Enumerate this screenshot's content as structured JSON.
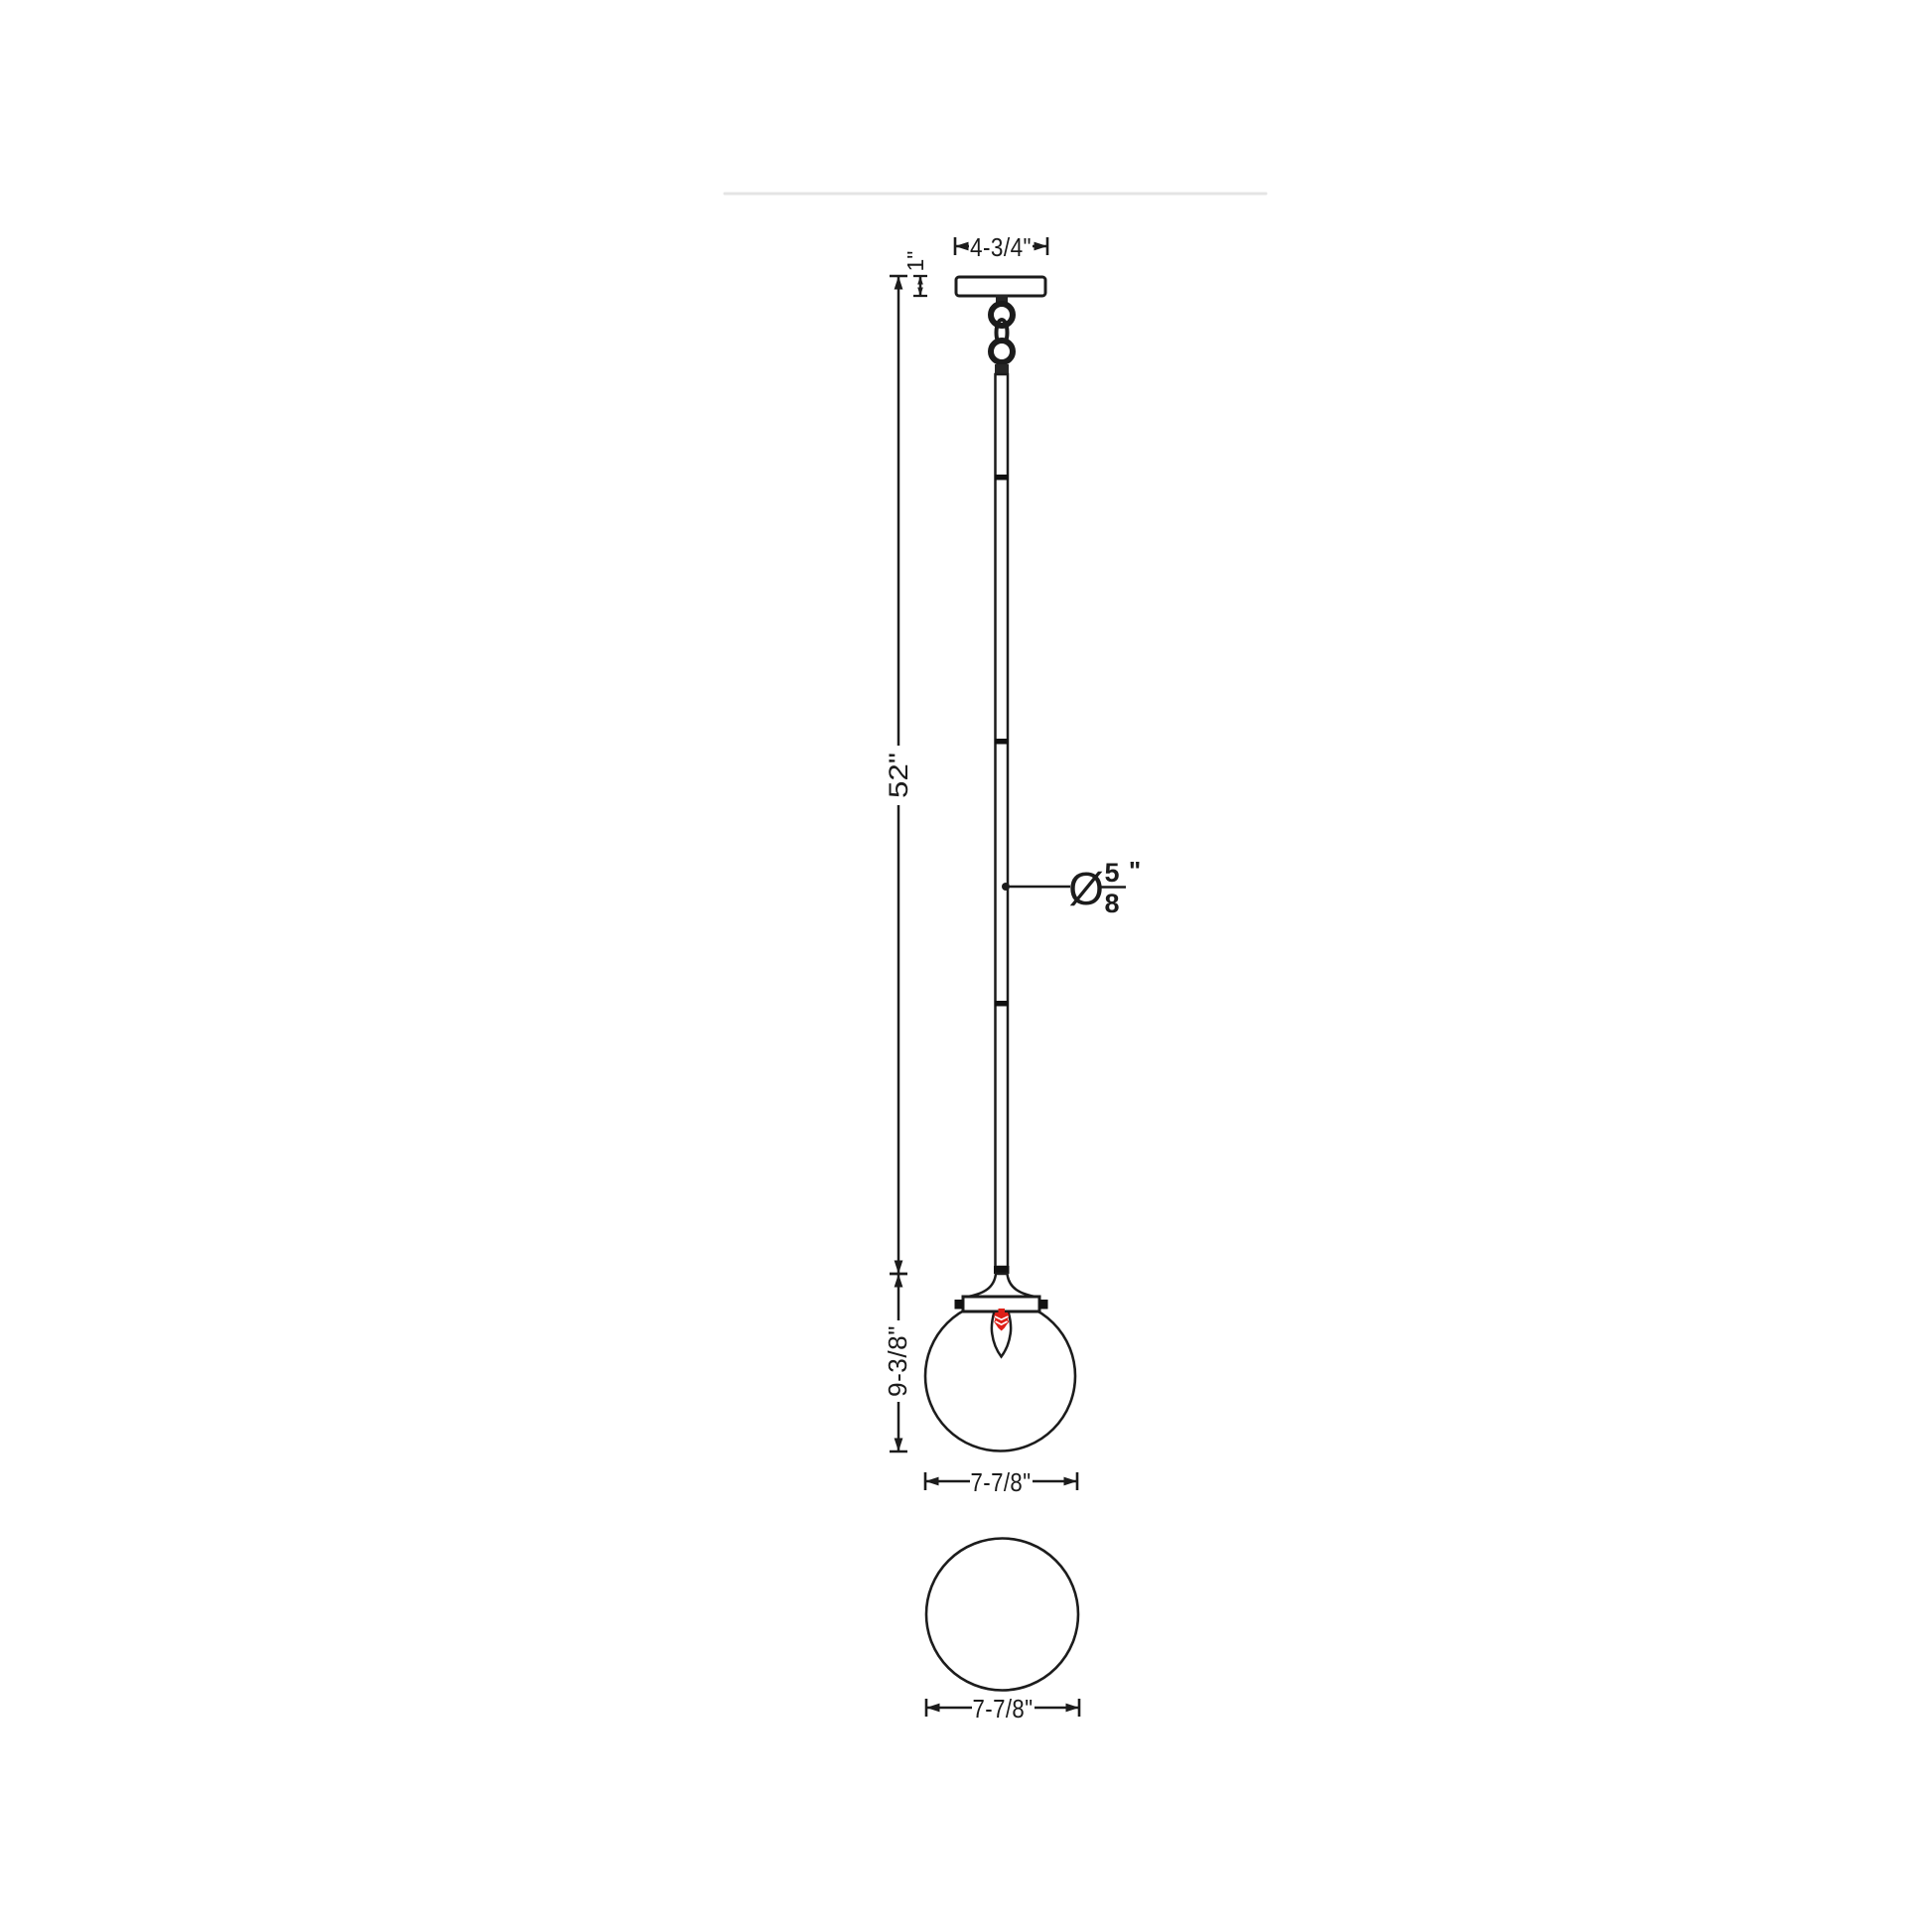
{
  "drawing": {
    "title": "pendant-light-dimension-diagram",
    "views": [
      "side-elevation",
      "bottom-plan"
    ],
    "colors": {
      "line": "#1c1c1c",
      "bulb_red": "#de1f17",
      "divider_gray": "#e4e4e4",
      "background": "#ffffff"
    },
    "labels": {
      "canopy_width": "4-3/4\"",
      "canopy_height": "1\"",
      "overall_stem_length": "52\"",
      "stem_diameter_symbol": "Ø",
      "stem_diameter_numerator": "5",
      "stem_diameter_denominator": "8",
      "stem_diameter_unit": "\"",
      "globe_height": "9-3/8\"",
      "globe_width": "7-7/8\"",
      "bottom_view_width": "7-7/8\""
    }
  }
}
